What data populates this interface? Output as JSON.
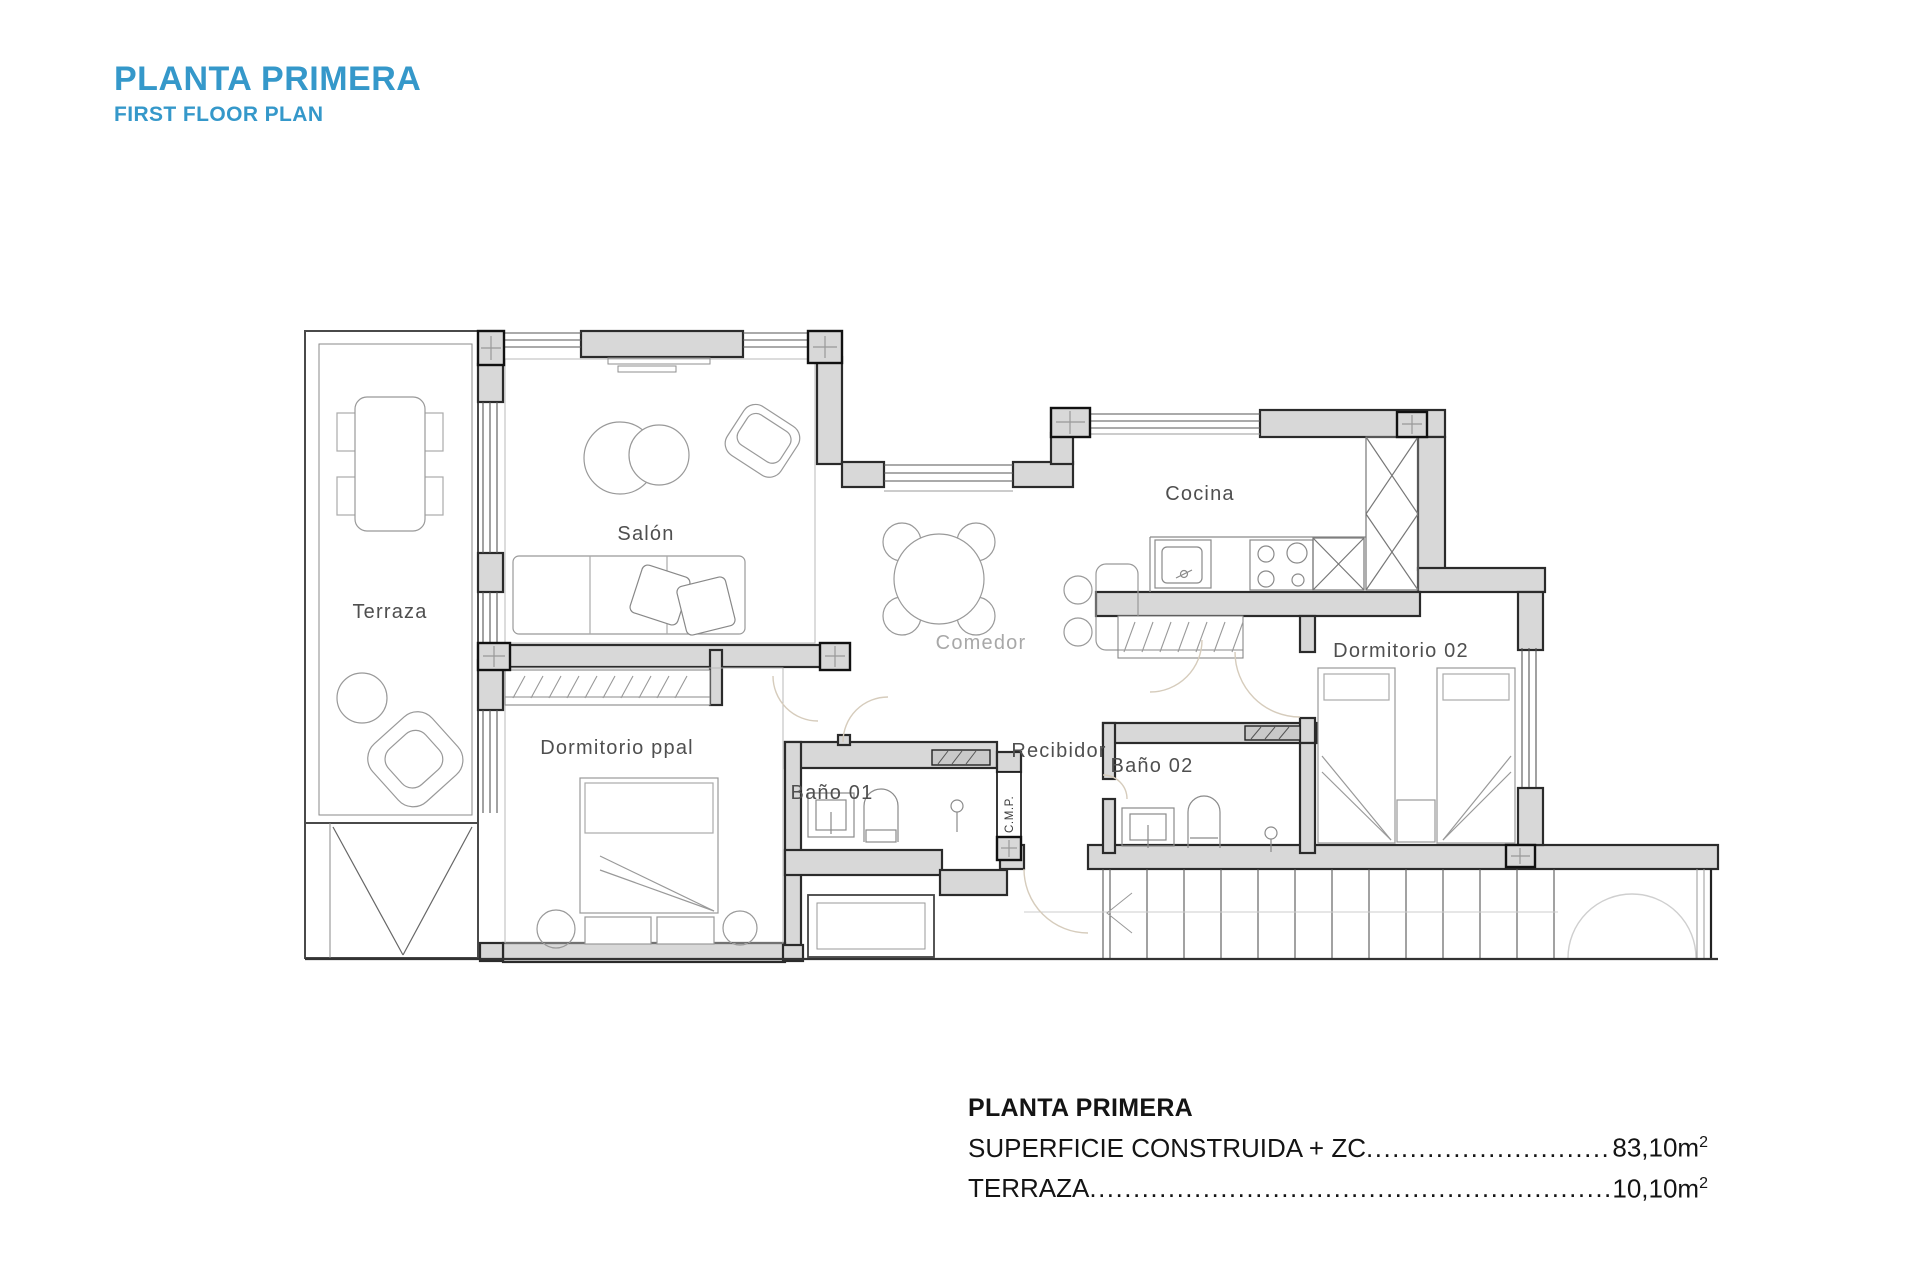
{
  "header": {
    "title": "PLANTA PRIMERA",
    "subtitle": "FIRST FLOOR PLAN",
    "accent_color": "#3598ca"
  },
  "plan": {
    "rooms": {
      "terraza": "Terraza",
      "salon": "Salón",
      "comedor": "Comedor",
      "cocina": "Cocina",
      "dormitorio_ppal": "Dormitorio ppal",
      "dormitorio_02": "Dormitorio 02",
      "bano_01": "Baño 01",
      "bano_02": "Baño 02",
      "recibidor": "Recibidor",
      "cmp": "C.M.P."
    },
    "colors": {
      "wall_fill": "#d8d8d8",
      "wall_stroke": "#2b2b2b",
      "furniture_stroke": "#999999",
      "label_color": "#4f4f4f"
    }
  },
  "summary": {
    "title": "PLANTA PRIMERA",
    "rows": [
      {
        "label": "SUPERFICIE CONSTRUIDA + ZC",
        "leader": "................................................................................................................",
        "value": "83,10m",
        "sup": "2"
      },
      {
        "label": "TERRAZA",
        "leader": "................................................................................................................",
        "value": "10,10m",
        "sup": "2"
      }
    ]
  }
}
